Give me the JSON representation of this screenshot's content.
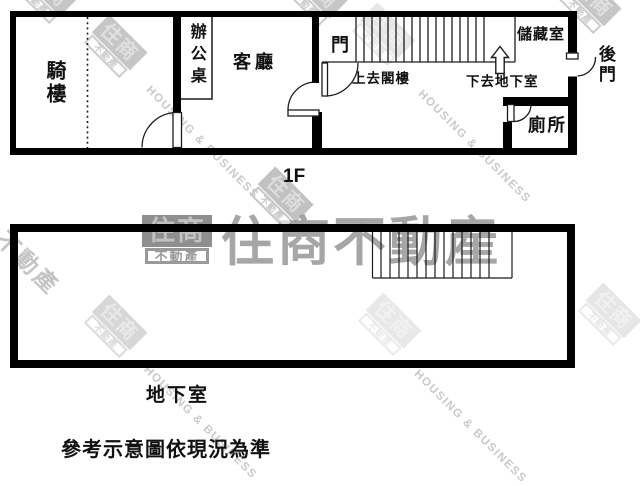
{
  "floor1": {
    "floor_tag": "1F",
    "rooms": {
      "arcade": "騎樓",
      "office_desk": "辦公桌",
      "living_room": "客廳",
      "door": "門",
      "storage": "儲藏室",
      "back_door": "後門",
      "toilet": "廁所"
    },
    "annotations": {
      "up_to_attic": "上去閣樓",
      "down_to_basement": "下去地下室"
    }
  },
  "basement": {
    "label": "地下室"
  },
  "caption": "參考示意圖依現況為準",
  "watermark": {
    "brand_box_top": "住商",
    "brand_box_bottom": "不動產",
    "brand_full": "住商不動產",
    "brand_en": "HOUSING & BUSINESS",
    "fragment": "不動產"
  },
  "colors": {
    "wall": "#000000",
    "line": "#1c1c1c",
    "watermark_gray": "#a6a6a6",
    "watermark_light": "#c9c9c9"
  }
}
